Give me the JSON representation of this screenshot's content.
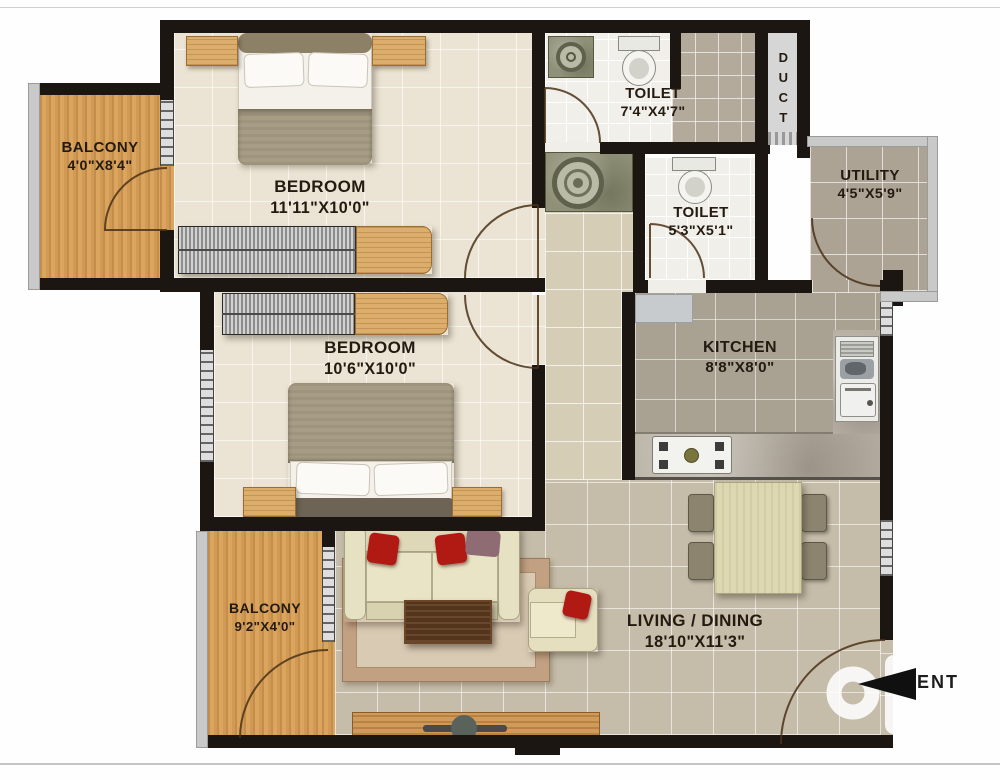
{
  "rooms": {
    "balcony_top": {
      "name": "BALCONY",
      "dims": "4'0\"X8'4\""
    },
    "bedroom_top": {
      "name": "BEDROOM",
      "dims": "11'11\"X10'0\""
    },
    "toilet_top": {
      "name": "TOILET",
      "dims": "7'4\"X4'7\""
    },
    "duct": {
      "name": "DUCT"
    },
    "toilet_mid": {
      "name": "TOILET",
      "dims": "5'3\"X5'1\""
    },
    "utility": {
      "name": "UTILITY",
      "dims": "4'5\"X5'9\""
    },
    "kitchen": {
      "name": "KITCHEN",
      "dims": "8'8\"X8'0\""
    },
    "bedroom_mid": {
      "name": "BEDROOM",
      "dims": "10'6\"X10'0\""
    },
    "balcony_bottom": {
      "name": "BALCONY",
      "dims": "9'2\"X4'0\""
    },
    "living_dining": {
      "name": "LIVING / DINING",
      "dims": "18'10\"X11'3\""
    }
  },
  "entrance": {
    "label": "ENT"
  },
  "watermark": {
    "brand": "olx",
    "caption": "INDIA"
  },
  "colors": {
    "wall": "#1b1611",
    "wood": "#dba55e",
    "accent_red": "#b01a12",
    "floor_living": "#c5bca9"
  }
}
